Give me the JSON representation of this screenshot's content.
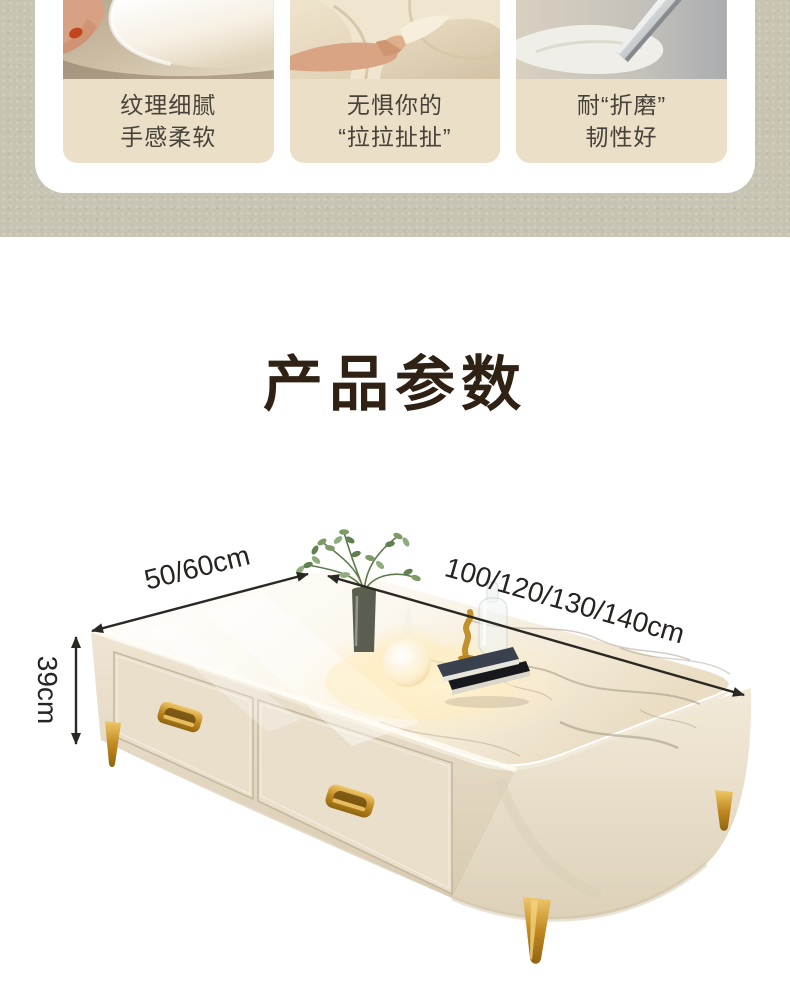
{
  "theme": {
    "texture_background": "#c8c4b3",
    "card_background": "#ffffff",
    "feature_label_background": "#ecdfc7",
    "feature_label_text": "#47423a",
    "title_color": "#2f2114",
    "dimension_text_color": "#262320",
    "table_cream": "#e7ddc9",
    "gold_accent": "#c9942e"
  },
  "features": {
    "items": [
      {
        "photo": "leather-texture-closeup",
        "line1": "纹理细腻",
        "line2": "手感柔软"
      },
      {
        "photo": "hand-pulling-fabric",
        "line1": "无惧你的",
        "line2": "“拉拉扯扯”"
      },
      {
        "photo": "blade-on-fabric",
        "line1": "耐“折磨”",
        "line2": "韧性好"
      }
    ]
  },
  "params": {
    "title": "产品参数",
    "dimensions": {
      "depth": "50/60cm",
      "width": "100/120/130/140cm",
      "height": "39cm"
    }
  }
}
